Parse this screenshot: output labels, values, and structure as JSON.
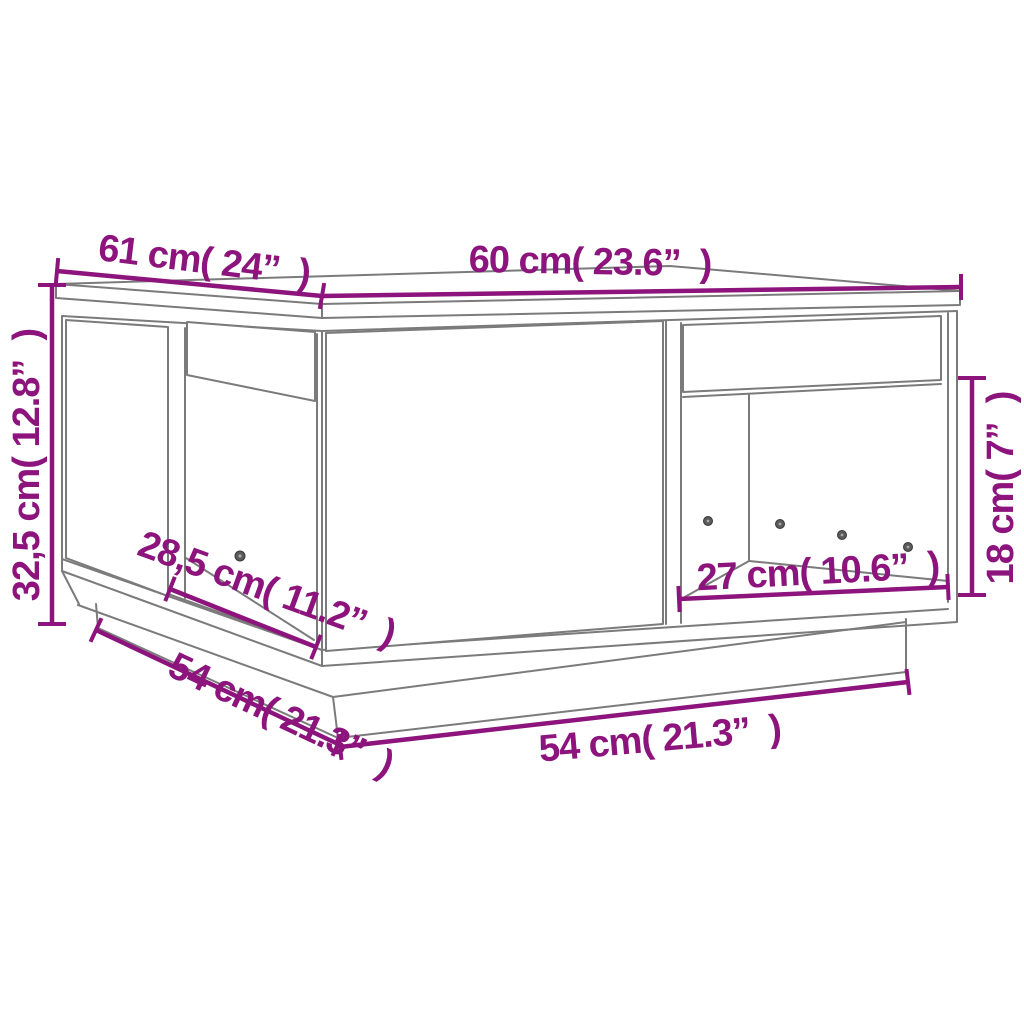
{
  "diagram": {
    "kind": "furniture-dimension-diagram",
    "subject": "coffee table with two open compartments and recessed plinth base",
    "colors": {
      "dimension_accent": "#8C147C",
      "line_art": "#7b7b7b",
      "background": "#ffffff"
    },
    "dimensions": [
      {
        "id": "top-left-edge",
        "label": "61 cm( 24”  )",
        "cm": "61",
        "inches": "24"
      },
      {
        "id": "top-right-edge",
        "label": "60 cm( 23.6”  )",
        "cm": "60",
        "inches": "23.6"
      },
      {
        "id": "overall-height",
        "label": "32,5 cm( 12.8”  )",
        "cm": "32,5",
        "inches": "12.8"
      },
      {
        "id": "left-opening-width",
        "label": "28,5 cm( 11.2”  )",
        "cm": "28,5",
        "inches": "11.2"
      },
      {
        "id": "base-left-edge",
        "label": "54 cm( 21.3”  )",
        "cm": "54",
        "inches": "21.3"
      },
      {
        "id": "base-front-edge",
        "label": "54 cm( 21.3”  )",
        "cm": "54",
        "inches": "21.3"
      },
      {
        "id": "right-opening-width",
        "label": "27 cm( 10.6”  )",
        "cm": "27",
        "inches": "10.6"
      },
      {
        "id": "right-opening-height",
        "label": "18 cm( 7”  )",
        "cm": "18",
        "inches": "7"
      }
    ]
  }
}
